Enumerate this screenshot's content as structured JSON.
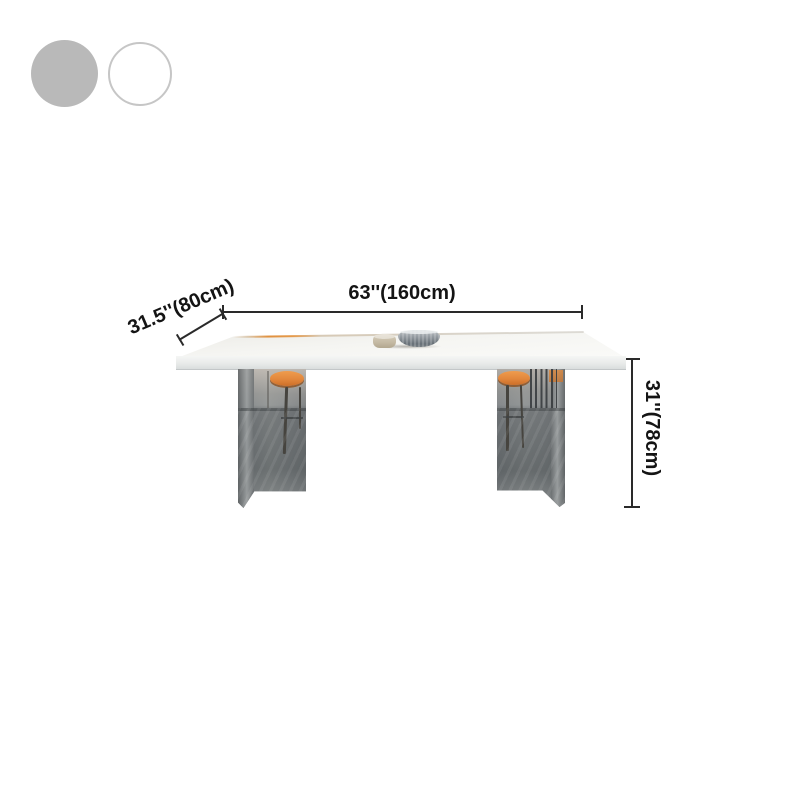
{
  "view": {
    "background": "#ffffff"
  },
  "swatches": {
    "options": [
      {
        "id": "gray",
        "fill": "#b9b9b9",
        "border": "#b9b9b9"
      },
      {
        "id": "white",
        "fill": "#ffffff",
        "border": "#c6c6c6"
      }
    ]
  },
  "product": {
    "dimensions": {
      "width_label": "63''(160cm)",
      "depth_label": "31.5''(80cm)",
      "height_label": "31''(78cm)"
    },
    "colors": {
      "annotation_line": "#2a2a2a",
      "annotation_text": "#141414",
      "tabletop_white": "#f2f2f0",
      "tabletop_edge_warm": "#e0913f",
      "leg_glass_gray": "#8a8e90",
      "stool_seat_orange": "#e2873c",
      "stool_frame_dark": "#46443f",
      "bowl_gray": "#8d959b",
      "cup_beige": "#c6bba5"
    }
  }
}
